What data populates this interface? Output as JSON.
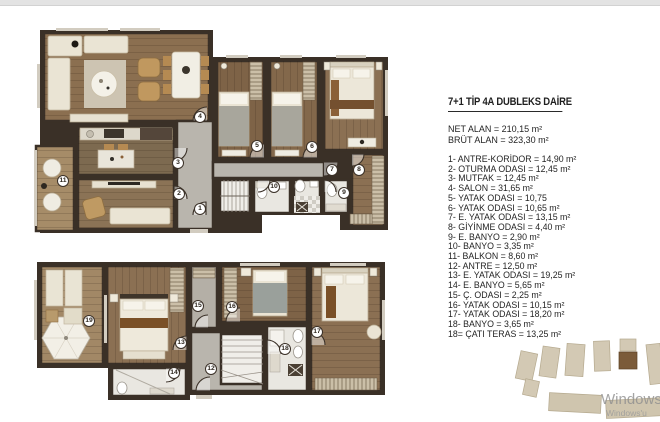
{
  "window": {
    "top_strip_color": "#e3e3e3"
  },
  "panel": {
    "title": "7+1 TİP 4A DUBLEKS DAİRE",
    "net_alan": "NET ALAN = 210,15 m²",
    "brut_alan": "BRÜT ALAN = 323,30 m²",
    "rooms": [
      "1- ANTRE-KORİDOR  = 14,90 m²",
      "2- OTURMA ODASI = 12,45 m²",
      "3- MUTFAK = 12,45 m²",
      "4- SALON = 31,65 m²",
      "5- YATAK ODASI = 10,75",
      "6- YATAK ODASI = 10,65 m²",
      "7- E. YATAK ODASI = 13,15 m²",
      "8- GİYİNME ODASI = 4,40 m²",
      "9- E. BANYO = 2,90 m²",
      "10- BANYO = 3,35 m²",
      "11- BALKON = 8,60 m²",
      "12- ANTRE = 12,50 m²",
      "13- E. YATAK ODASI = 19,25 m²",
      "14- E. BANYO = 5,65 m²",
      "15- Ç. ODASI = 2,25 m²",
      "16- YATAK ODASI = 10,15 m²",
      "17- YATAK ODASI = 18,20 m²",
      "18- BANYO = 3,65 m²",
      "18= ÇATI TERAS = 13,25 m²"
    ]
  },
  "plans": {
    "upper_markers": [
      {
        "label": "1",
        "x": 200,
        "y": 209
      },
      {
        "label": "2",
        "x": 179,
        "y": 194
      },
      {
        "label": "3",
        "x": 178,
        "y": 163
      },
      {
        "label": "4",
        "x": 200,
        "y": 117
      },
      {
        "label": "5",
        "x": 257,
        "y": 146
      },
      {
        "label": "6",
        "x": 312,
        "y": 147
      },
      {
        "label": "7",
        "x": 332,
        "y": 170
      },
      {
        "label": "8",
        "x": 359,
        "y": 170
      },
      {
        "label": "9",
        "x": 344,
        "y": 193
      },
      {
        "label": "10",
        "x": 274,
        "y": 187
      },
      {
        "label": "11",
        "x": 63,
        "y": 181
      }
    ],
    "lower_markers": [
      {
        "label": "12",
        "x": 211,
        "y": 369
      },
      {
        "label": "13",
        "x": 181,
        "y": 343
      },
      {
        "label": "14",
        "x": 174,
        "y": 373
      },
      {
        "label": "15",
        "x": 198,
        "y": 306
      },
      {
        "label": "16",
        "x": 232,
        "y": 307
      },
      {
        "label": "17",
        "x": 317,
        "y": 332
      },
      {
        "label": "18",
        "x": 285,
        "y": 349
      },
      {
        "label": "19",
        "x": 89,
        "y": 321
      }
    ]
  },
  "colors": {
    "walls": "#3a3027",
    "wood": "#8b7053",
    "corridor": "#b9b5ad",
    "furniture": "#eae4d4",
    "site_building": "#d3c9b4",
    "site_highlight": "#7b5b39"
  },
  "watermark": {
    "line1": "Windows",
    "line2": "Windows'u"
  }
}
